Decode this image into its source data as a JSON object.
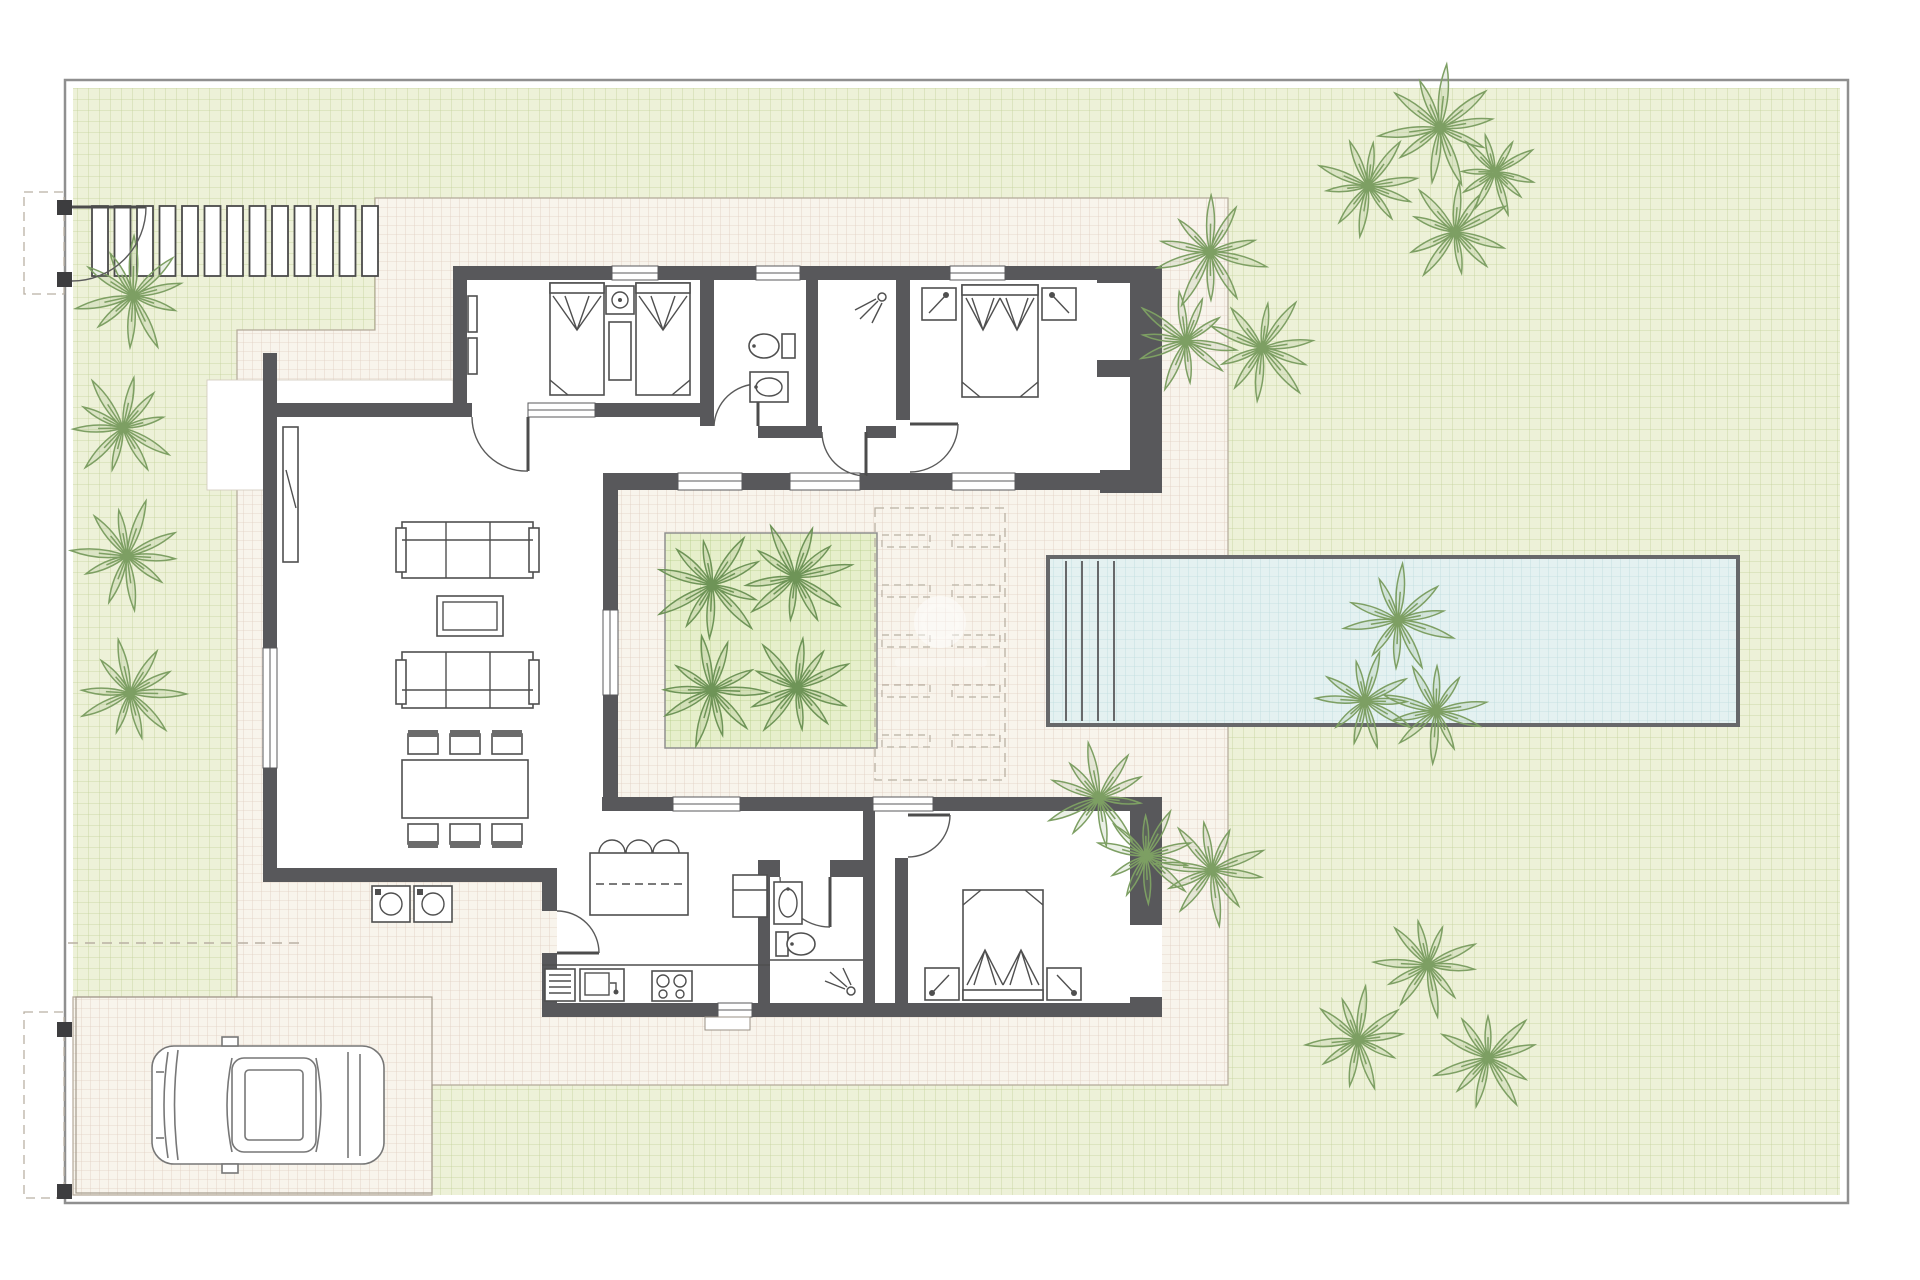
{
  "colors": {
    "page_bg": "#ffffff",
    "plot_border": "#8f8f8f",
    "garden_bg": "#edf1d8",
    "garden_line": "#c3d29a",
    "terrace_bg": "#f8f4ec",
    "terrace_line": "#e1cec1",
    "terrace_edge": "#b3a999",
    "pool_water": "#e4f1f1",
    "pool_line": "#bedcdd",
    "pool_border": "#67686a",
    "planter_bg": "#e6efcb",
    "planter_line": "#b4cc87",
    "wall": "#58585b",
    "furniture_line": "#4f4f4f",
    "palm_garden": "#7d9f63",
    "palm_courtyard": "#6e9457",
    "dash": "#b9b0a3",
    "watermark": "#ffffff"
  },
  "pergola": {
    "slat_count": 13,
    "x_start": 92,
    "y": 206,
    "slat_width": 16,
    "slat_height": 70,
    "step": 22.5
  },
  "garden_palms": [
    [
      133,
      296,
      62
    ],
    [
      123,
      428,
      58
    ],
    [
      127,
      556,
      60
    ],
    [
      130,
      693,
      58
    ],
    [
      1440,
      128,
      66
    ],
    [
      1368,
      186,
      56
    ],
    [
      1455,
      232,
      58
    ],
    [
      1495,
      172,
      46
    ],
    [
      1210,
      252,
      62
    ],
    [
      1186,
      341,
      56
    ],
    [
      1262,
      348,
      60
    ],
    [
      1398,
      620,
      60
    ],
    [
      1365,
      701,
      54
    ],
    [
      1436,
      711,
      56
    ],
    [
      1099,
      798,
      58
    ],
    [
      1146,
      856,
      54
    ],
    [
      1212,
      870,
      60
    ],
    [
      1358,
      1040,
      56
    ],
    [
      1428,
      965,
      56
    ],
    [
      1488,
      1058,
      58
    ]
  ],
  "courtyard_palms": [
    [
      712,
      585,
      62
    ],
    [
      795,
      577,
      60
    ],
    [
      712,
      690,
      60
    ],
    [
      797,
      688,
      58
    ]
  ],
  "planter": {
    "x": 665,
    "y": 533,
    "w": 212,
    "h": 215
  },
  "lounger_area": {
    "x": 875,
    "y": 508,
    "w": 130,
    "h": 272,
    "cols": [
      882,
      952
    ],
    "rows": [
      535,
      585,
      635,
      685,
      735
    ],
    "bar_w": 48,
    "bar_h": 12
  },
  "pool": {
    "x": 1048,
    "y": 557,
    "w": 690,
    "h": 168,
    "steps": [
      1066,
      1082,
      1098,
      1114
    ]
  },
  "watermark": {
    "cx": 940,
    "cy": 622,
    "r": 26
  }
}
